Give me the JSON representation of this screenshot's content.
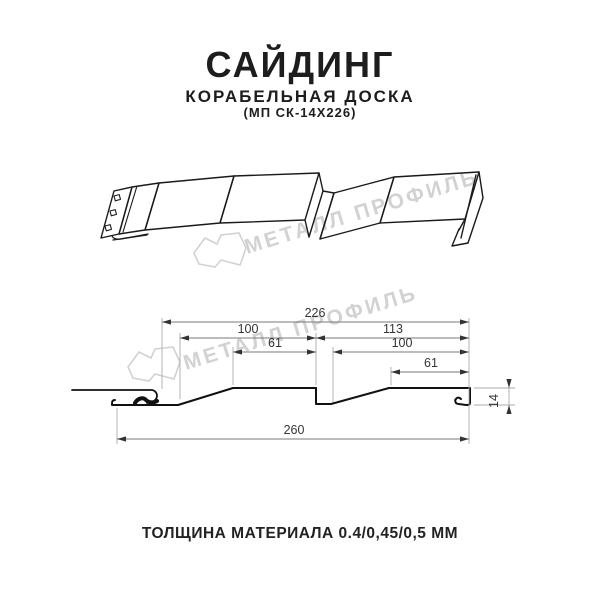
{
  "header": {
    "title": "САЙДИНГ",
    "subtitle": "КОРАБЕЛЬНАЯ ДОСКА",
    "model": "(МП СК-14Х226)"
  },
  "watermark": {
    "text": "МЕТАЛЛ ПРОФИЛЬ",
    "color": "#d2d2d2"
  },
  "dimensions": {
    "overall_top": "226",
    "upper_left": "100",
    "upper_right": "113",
    "inner_left": "61",
    "inner_right": "100",
    "flat_right": "61",
    "overall_bottom": "260",
    "height": "14"
  },
  "footer": {
    "text": "ТОЛЩИНА МАТЕРИАЛА 0.4/0,45/0,5 ММ"
  },
  "colors": {
    "drawing_line": "#1a1a1a",
    "dimension_line": "#7a7a7a",
    "extension_line": "#ababab",
    "arrow": "#333333",
    "text": "#1d1d1d"
  }
}
